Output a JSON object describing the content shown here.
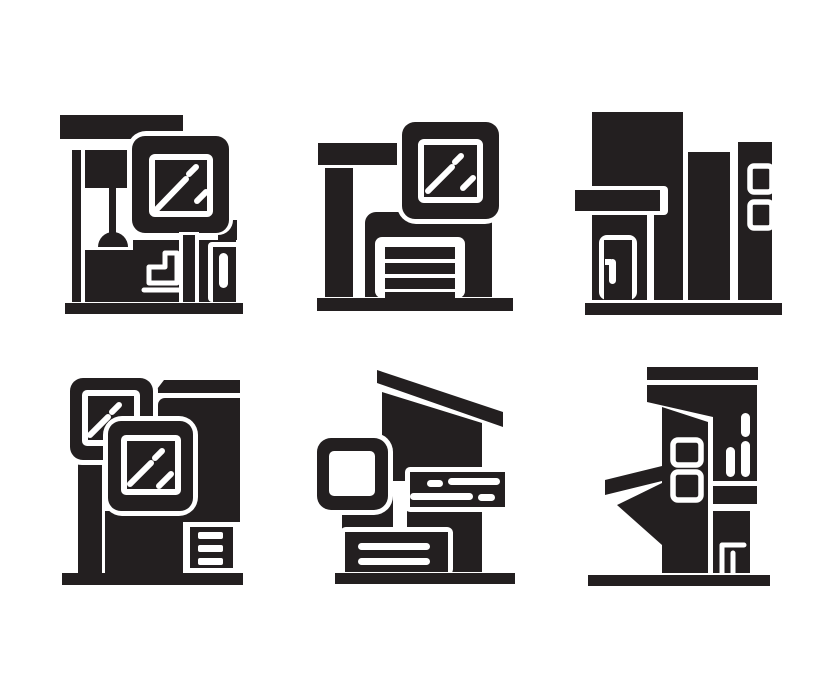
{
  "page": {
    "background": "#ffffff",
    "glyph_color": "#231f20",
    "title": "Building icons sheet"
  },
  "grid": {
    "rows": 2,
    "cols": 3
  },
  "icons": [
    {
      "name": "interior-room-building-icon",
      "grid": "row-1-col-1",
      "features": "ceiling beam, pendant lamp, framed window with glass shine, toilet, column"
    },
    {
      "name": "garage-store-building-icon",
      "grid": "row-1-col-2",
      "features": "flat roof, framed window with glass shine, slatted garage door"
    },
    {
      "name": "city-buildings-icon",
      "grid": "row-1-col-3",
      "features": "tower with canopy and door, two tower blocks, two small windows"
    },
    {
      "name": "double-window-building-icon",
      "grid": "row-2-col-1",
      "features": "two overlapping framed windows with glass shine, slatted vent"
    },
    {
      "name": "slanted-roof-house-icon",
      "grid": "row-2-col-2",
      "features": "slanted roof, square window frame, sign bar with dashes, slatted base"
    },
    {
      "name": "modern-tower-building-icon",
      "grid": "row-2-col-3",
      "features": "wide roof, two small windows, angled left wing, door"
    }
  ]
}
